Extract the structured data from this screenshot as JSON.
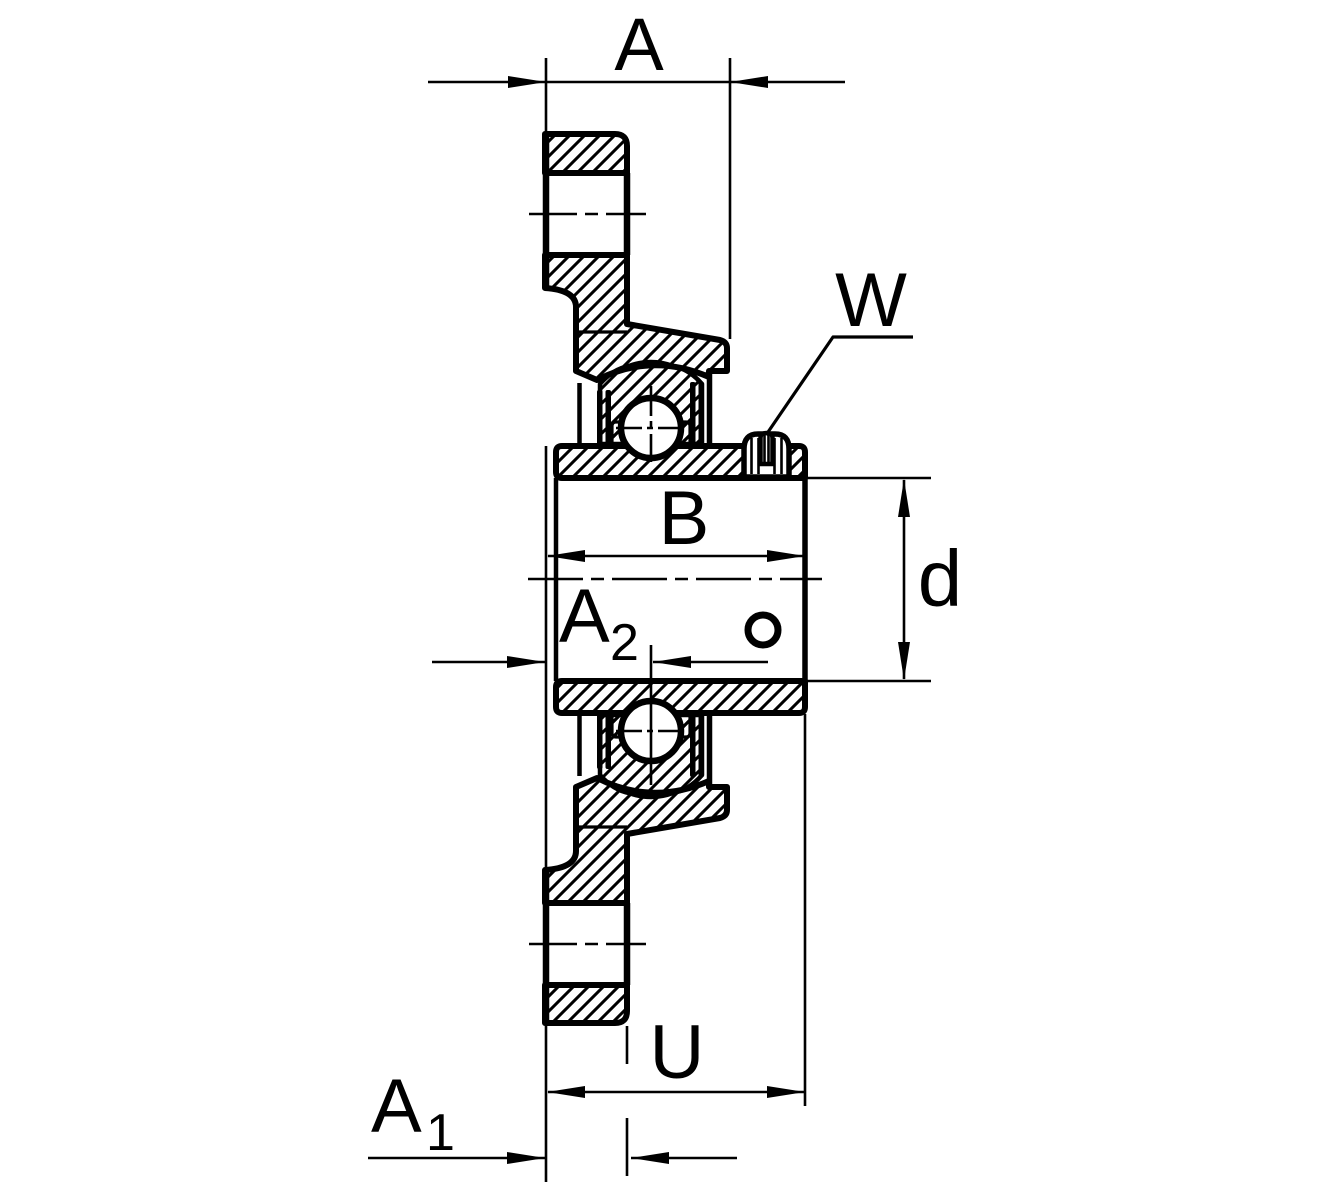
{
  "labels": {
    "a": "A",
    "w": "W",
    "b": "B",
    "d": "d",
    "u": "U",
    "a1_base": "A",
    "a1_sub": "1",
    "a2_base": "A",
    "a2_sub": "2"
  },
  "colors": {
    "line": "#000000",
    "background": "#ffffff"
  }
}
